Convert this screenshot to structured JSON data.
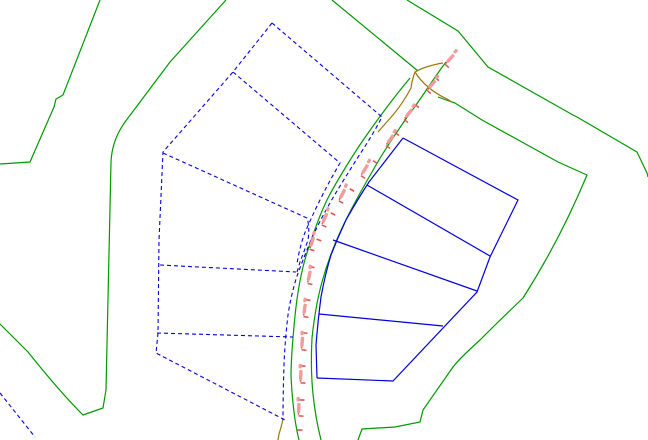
{
  "canvas": {
    "width": 648,
    "height": 440,
    "background": "#ffffff"
  },
  "colors": {
    "boundary_green": "#009900",
    "parcel_blue": "#0000dd",
    "track_olive": "#9c750f",
    "station_tick_red": "#dd5555",
    "station_text_pink": "#f29b9b"
  },
  "layers": [
    {
      "id": "survey-boundaries",
      "color": "#009900",
      "dashed": false,
      "width": 1.2,
      "paths": [
        "M100,0 L63,95 L56,99 L54,107 L30,162 L0,164",
        "M226,0 L170,62 L128,118 Q112,138 111,162 L106,390 L103,408 L83,415 Q60,392 28,352 Q12,336 0,324",
        "M332,0 L418,71",
        "M407,0 L458,31 L488,67 L573,115 L577,117 L637,152 L647,173 L648,177",
        "M438,97 Q446,100 455,103 L482,120 L558,162 L587,175 Q560,240 523,298 Q500,320 480,340 Q460,358 453,367 L423,410 L420,422 L395,427 L362,429 L358,440"
      ]
    },
    {
      "id": "road-edges",
      "color": "#009900",
      "dashed": false,
      "width": 1.2,
      "paths": [
        "M410,78 C395,96 380,116 366,136 C352,156 337,181 329,196 C319,215 311,240 306,256 C300,276 297,296 295,316 C293,336 291,356 291,376 C292,396 294,420 299,440",
        "M446,62 C433,79 421,99 408,116 C396,133 382,154 372,172 C361,191 350,211 342,228 C334,245 327,264 322,282 C317,300 314,319 312,338 C311,357 311,375 313,394 C315,414 318,428 321,440"
      ]
    },
    {
      "id": "track-centerline",
      "color": "#9c750f",
      "dashed": false,
      "width": 1.2,
      "paths": [
        "M443,63 Q425,66 415,72 Q412,80 411,88 Q403,103 393,115 Q385,124 378,132",
        "M415,72 Q420,80 427,86 Q436,94 447,99 L452,102",
        "M283,419 Q281,428 279,434 L278,440"
      ]
    },
    {
      "id": "parcels-proposed-dashed",
      "color": "#0000dd",
      "dashed": true,
      "width": 1.1,
      "paths": [
        "M272,23 L233,72 L163,152 L159,240 L158,333 L156,353 L285,420",
        "M272,23 L382,117 Q372,136 360,154 Q346,176 334,196 Q321,218 311,240 Q302,262 297,276 Q291,295 288,315 Q285,340 284,365 Q283,395 283,420",
        "M233,72 L340,163 Q330,180 321,198 Q311,218 304,235 Q299,250 297,264",
        "M163,153 L307,218 Q310,227 308,240 Q304,252 300,262 L297,272",
        "M160,265 L296,272",
        "M157,333 L293,337",
        "M0,393 L35,437"
      ]
    },
    {
      "id": "parcels-solid",
      "color": "#0000dd",
      "dashed": false,
      "width": 1.2,
      "paths": [
        "M403,138 L518,200 L490,257 L477,292 L393,381 L317,378",
        "M403,138 Q386,160 369,182 Q356,202 346,220 Q338,237 331,255 Q325,275 321,297 Q318,320 316,345 L317,378",
        "M367,185 L490,256",
        "M333,240 L477,291",
        "M319,314 L443,326"
      ]
    }
  ],
  "station_markers": {
    "tick_color": "#dd5555",
    "text_color": "#f29b9b",
    "note": "illegible small rotated distance labels along road",
    "items": [
      {
        "x": 447,
        "y": 66,
        "angle": -48
      },
      {
        "x": 429,
        "y": 92,
        "angle": -50
      },
      {
        "x": 406,
        "y": 121,
        "angle": -52
      },
      {
        "x": 388,
        "y": 147,
        "angle": -55
      },
      {
        "x": 363,
        "y": 177,
        "angle": -58
      },
      {
        "x": 341,
        "y": 202,
        "angle": -62
      },
      {
        "x": 324,
        "y": 226,
        "angle": -66
      },
      {
        "x": 312,
        "y": 250,
        "angle": -72
      },
      {
        "x": 310,
        "y": 284,
        "angle": -78
      },
      {
        "x": 306,
        "y": 317,
        "angle": -82
      },
      {
        "x": 304,
        "y": 350,
        "angle": -85
      },
      {
        "x": 303,
        "y": 383,
        "angle": -88
      },
      {
        "x": 301,
        "y": 416,
        "angle": -88
      }
    ],
    "ticks": [
      {
        "x": 437,
        "y": 79,
        "angle": -49
      },
      {
        "x": 417,
        "y": 106,
        "angle": -51
      },
      {
        "x": 397,
        "y": 134,
        "angle": -53
      },
      {
        "x": 375,
        "y": 162,
        "angle": -56
      },
      {
        "x": 352,
        "y": 190,
        "angle": -60
      },
      {
        "x": 333,
        "y": 214,
        "angle": -64
      },
      {
        "x": 319,
        "y": 240,
        "angle": -70
      },
      {
        "x": 312,
        "y": 267,
        "angle": -75
      },
      {
        "x": 308,
        "y": 300,
        "angle": -80
      },
      {
        "x": 305,
        "y": 333,
        "angle": -84
      },
      {
        "x": 303,
        "y": 366,
        "angle": -86
      },
      {
        "x": 302,
        "y": 400,
        "angle": -88
      },
      {
        "x": 300,
        "y": 430,
        "angle": -88
      }
    ]
  }
}
